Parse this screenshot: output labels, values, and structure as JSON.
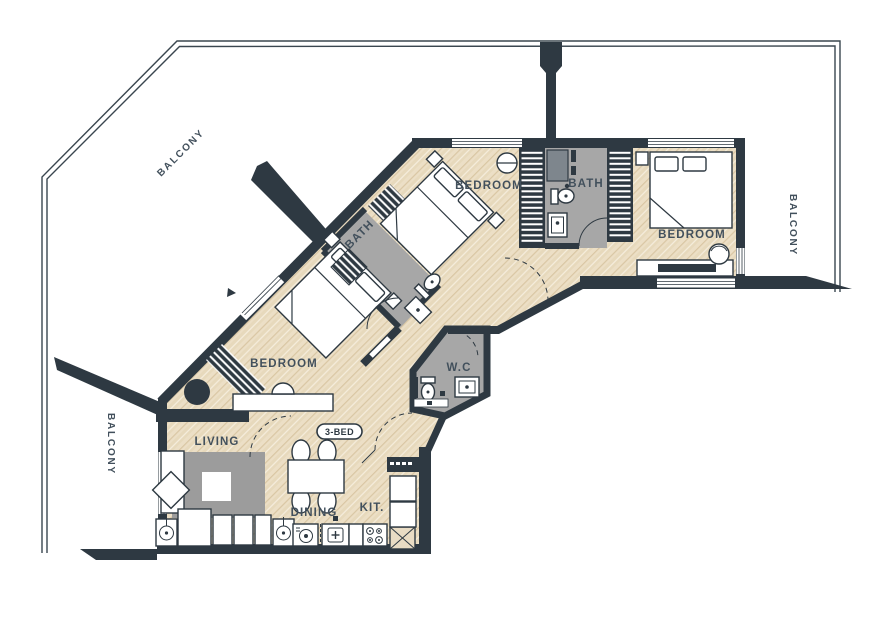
{
  "plan": {
    "unit_badge": "3-BED",
    "labels": {
      "balcony_top": "BALCONY",
      "balcony_right": "BALCONY",
      "balcony_left": "BALCONY",
      "bedroom_top": "BEDROOM",
      "bedroom_right": "BEDROOM",
      "bedroom_mid": "BEDROOM",
      "bath_top": "BATH",
      "bath_mid": "BATH",
      "wc": "W.C",
      "living": "LIVING",
      "dining": "DINING",
      "kitchen": "KIT."
    },
    "colors": {
      "wall": "#2e3942",
      "wood_floor": "#ecdfc6",
      "wood_grain": "#d8c4a0",
      "tile_floor": "#a7a7a7",
      "shower_block": "#7e868d",
      "rug": "#9c9c9c",
      "label_text": "#42505c",
      "background": "#ffffff"
    }
  }
}
